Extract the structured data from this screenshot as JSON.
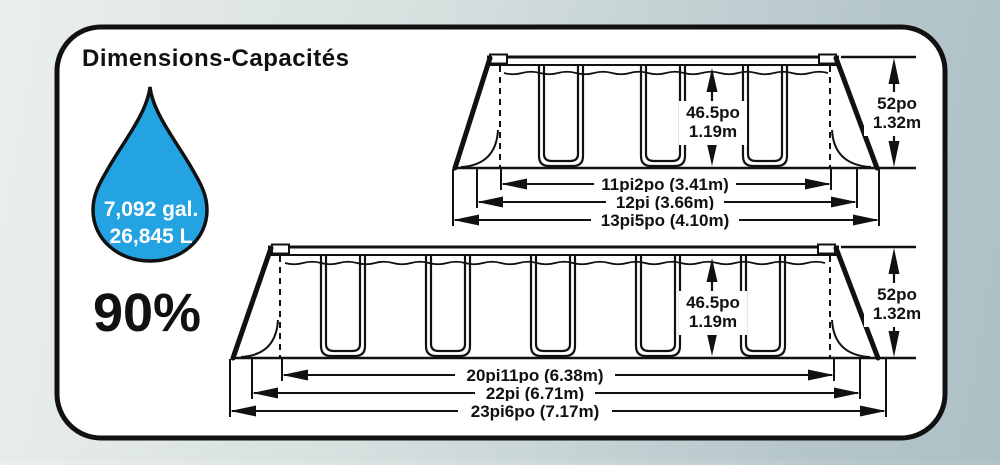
{
  "title": "Dimensions-Capacités",
  "capacity": {
    "gallons": "7,092 gal.",
    "liters": "26,845 L",
    "fill_percent": "90%"
  },
  "colors": {
    "drop_blue": "#24A3E3",
    "ink": "#111111"
  },
  "pool_small": {
    "water_height_po": "46.5po",
    "water_height_m": "1.19m",
    "frame_height_po": "52po",
    "frame_height_m": "1.32m",
    "width_inner": "11pi2po (3.41m)",
    "width_mid": "12pi (3.66m)",
    "width_outer": "13pi5po (4.10m)"
  },
  "pool_large": {
    "water_height_po": "46.5po",
    "water_height_m": "1.19m",
    "frame_height_po": "52po",
    "frame_height_m": "1.32m",
    "width_inner": "20pi11po (6.38m)",
    "width_mid": "22pi (6.71m)",
    "width_outer": "23pi6po (7.17m)"
  }
}
